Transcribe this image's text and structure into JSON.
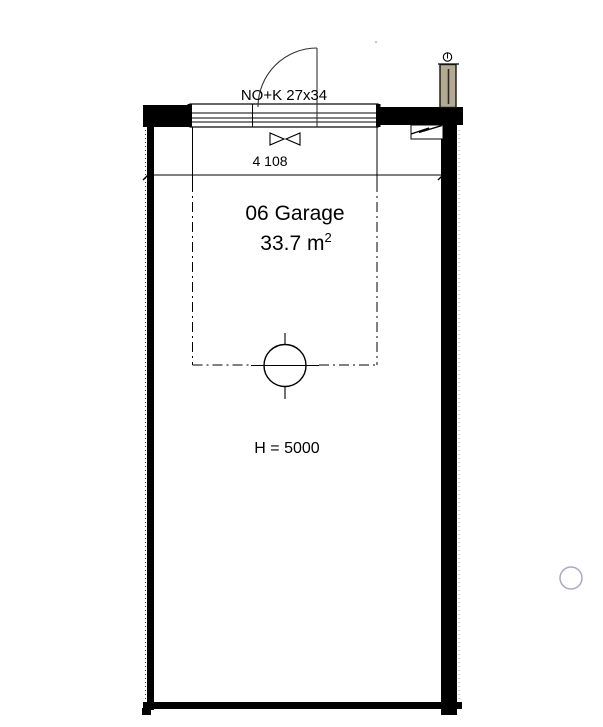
{
  "drawing": {
    "door_label": "NO+K 27x34",
    "dimension_width": "4 108",
    "room_title": "06 Garage",
    "room_area": "33.7 m",
    "room_area_exponent": "2",
    "ceiling_height": "H = 5000"
  },
  "colors": {
    "wall": "#000000",
    "line": "#1a1a1a",
    "downpipe_fill": "#b3aa91",
    "downpipe_stroke": "#141414",
    "accent_circle_stroke": "#a9a9c4",
    "faint_dot": "#c8c8c8"
  },
  "icons": {
    "door_swing": "door-swing-arc",
    "sectional_door": "garage-door-panel",
    "damper": "bowtie-damper-icon",
    "drain": "floor-drain-symbol",
    "downpipe": "downpipe-icon",
    "break": "break-line-icon"
  }
}
